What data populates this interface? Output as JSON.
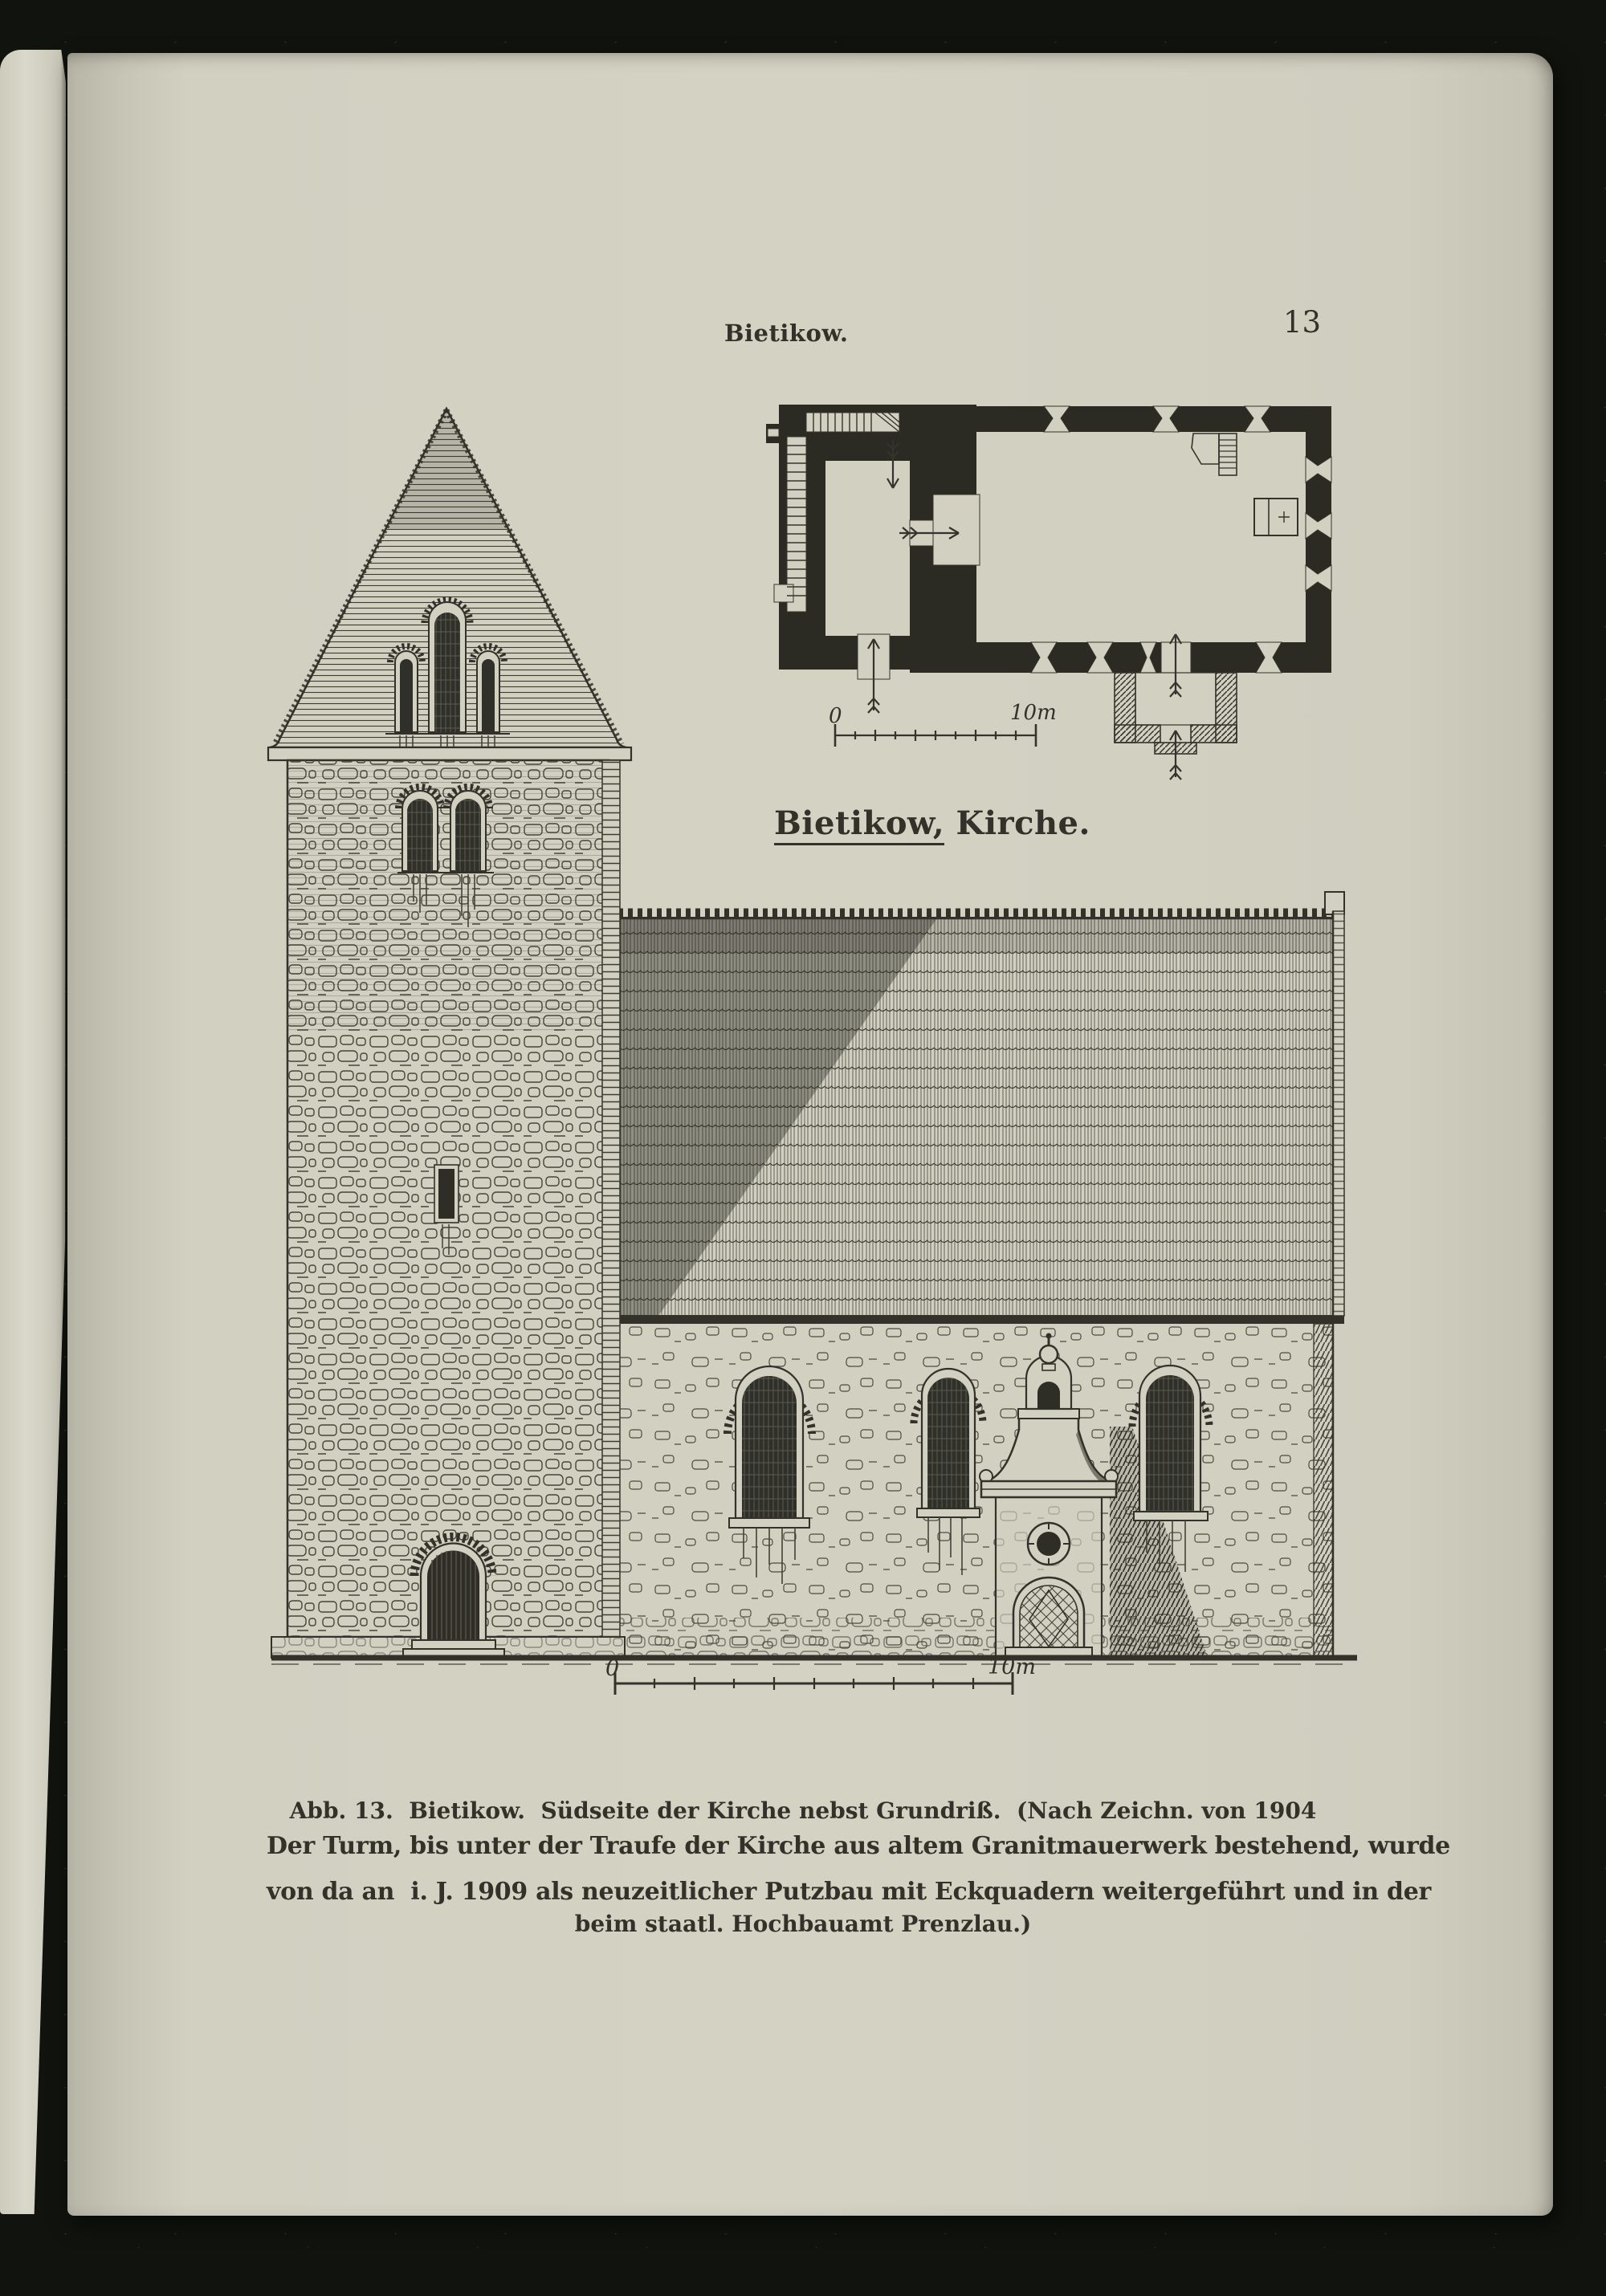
{
  "colors": {
    "background": "#10130e",
    "paper": "#d2d0c1",
    "ink": "#32312a"
  },
  "page": {
    "running_head": "Bietikow.",
    "page_number": "13"
  },
  "plan": {
    "label_prefix": "Bietikow,",
    "label_suffix": " Kirche.",
    "scale_zero": "0",
    "scale_ten": "10m"
  },
  "elevation": {
    "scale_zero": "0",
    "scale_ten": "10m"
  },
  "caption": {
    "line1": "Abb. 13.  Bietikow.  Südseite der Kirche nebst Grundriß.  (Nach Zeichn. von 1904",
    "line2": "beim staatl. Hochbauamt Prenzlau.)"
  },
  "paragraph": {
    "line1": "Der Turm, bis unter der Traufe der Kirche aus altem Granitmauerwerk bestehend, wurde",
    "line2": "von da an  i. J. 1909 als neuzeitlicher Putzbau mit Eckquadern weitergeführt und in der"
  }
}
